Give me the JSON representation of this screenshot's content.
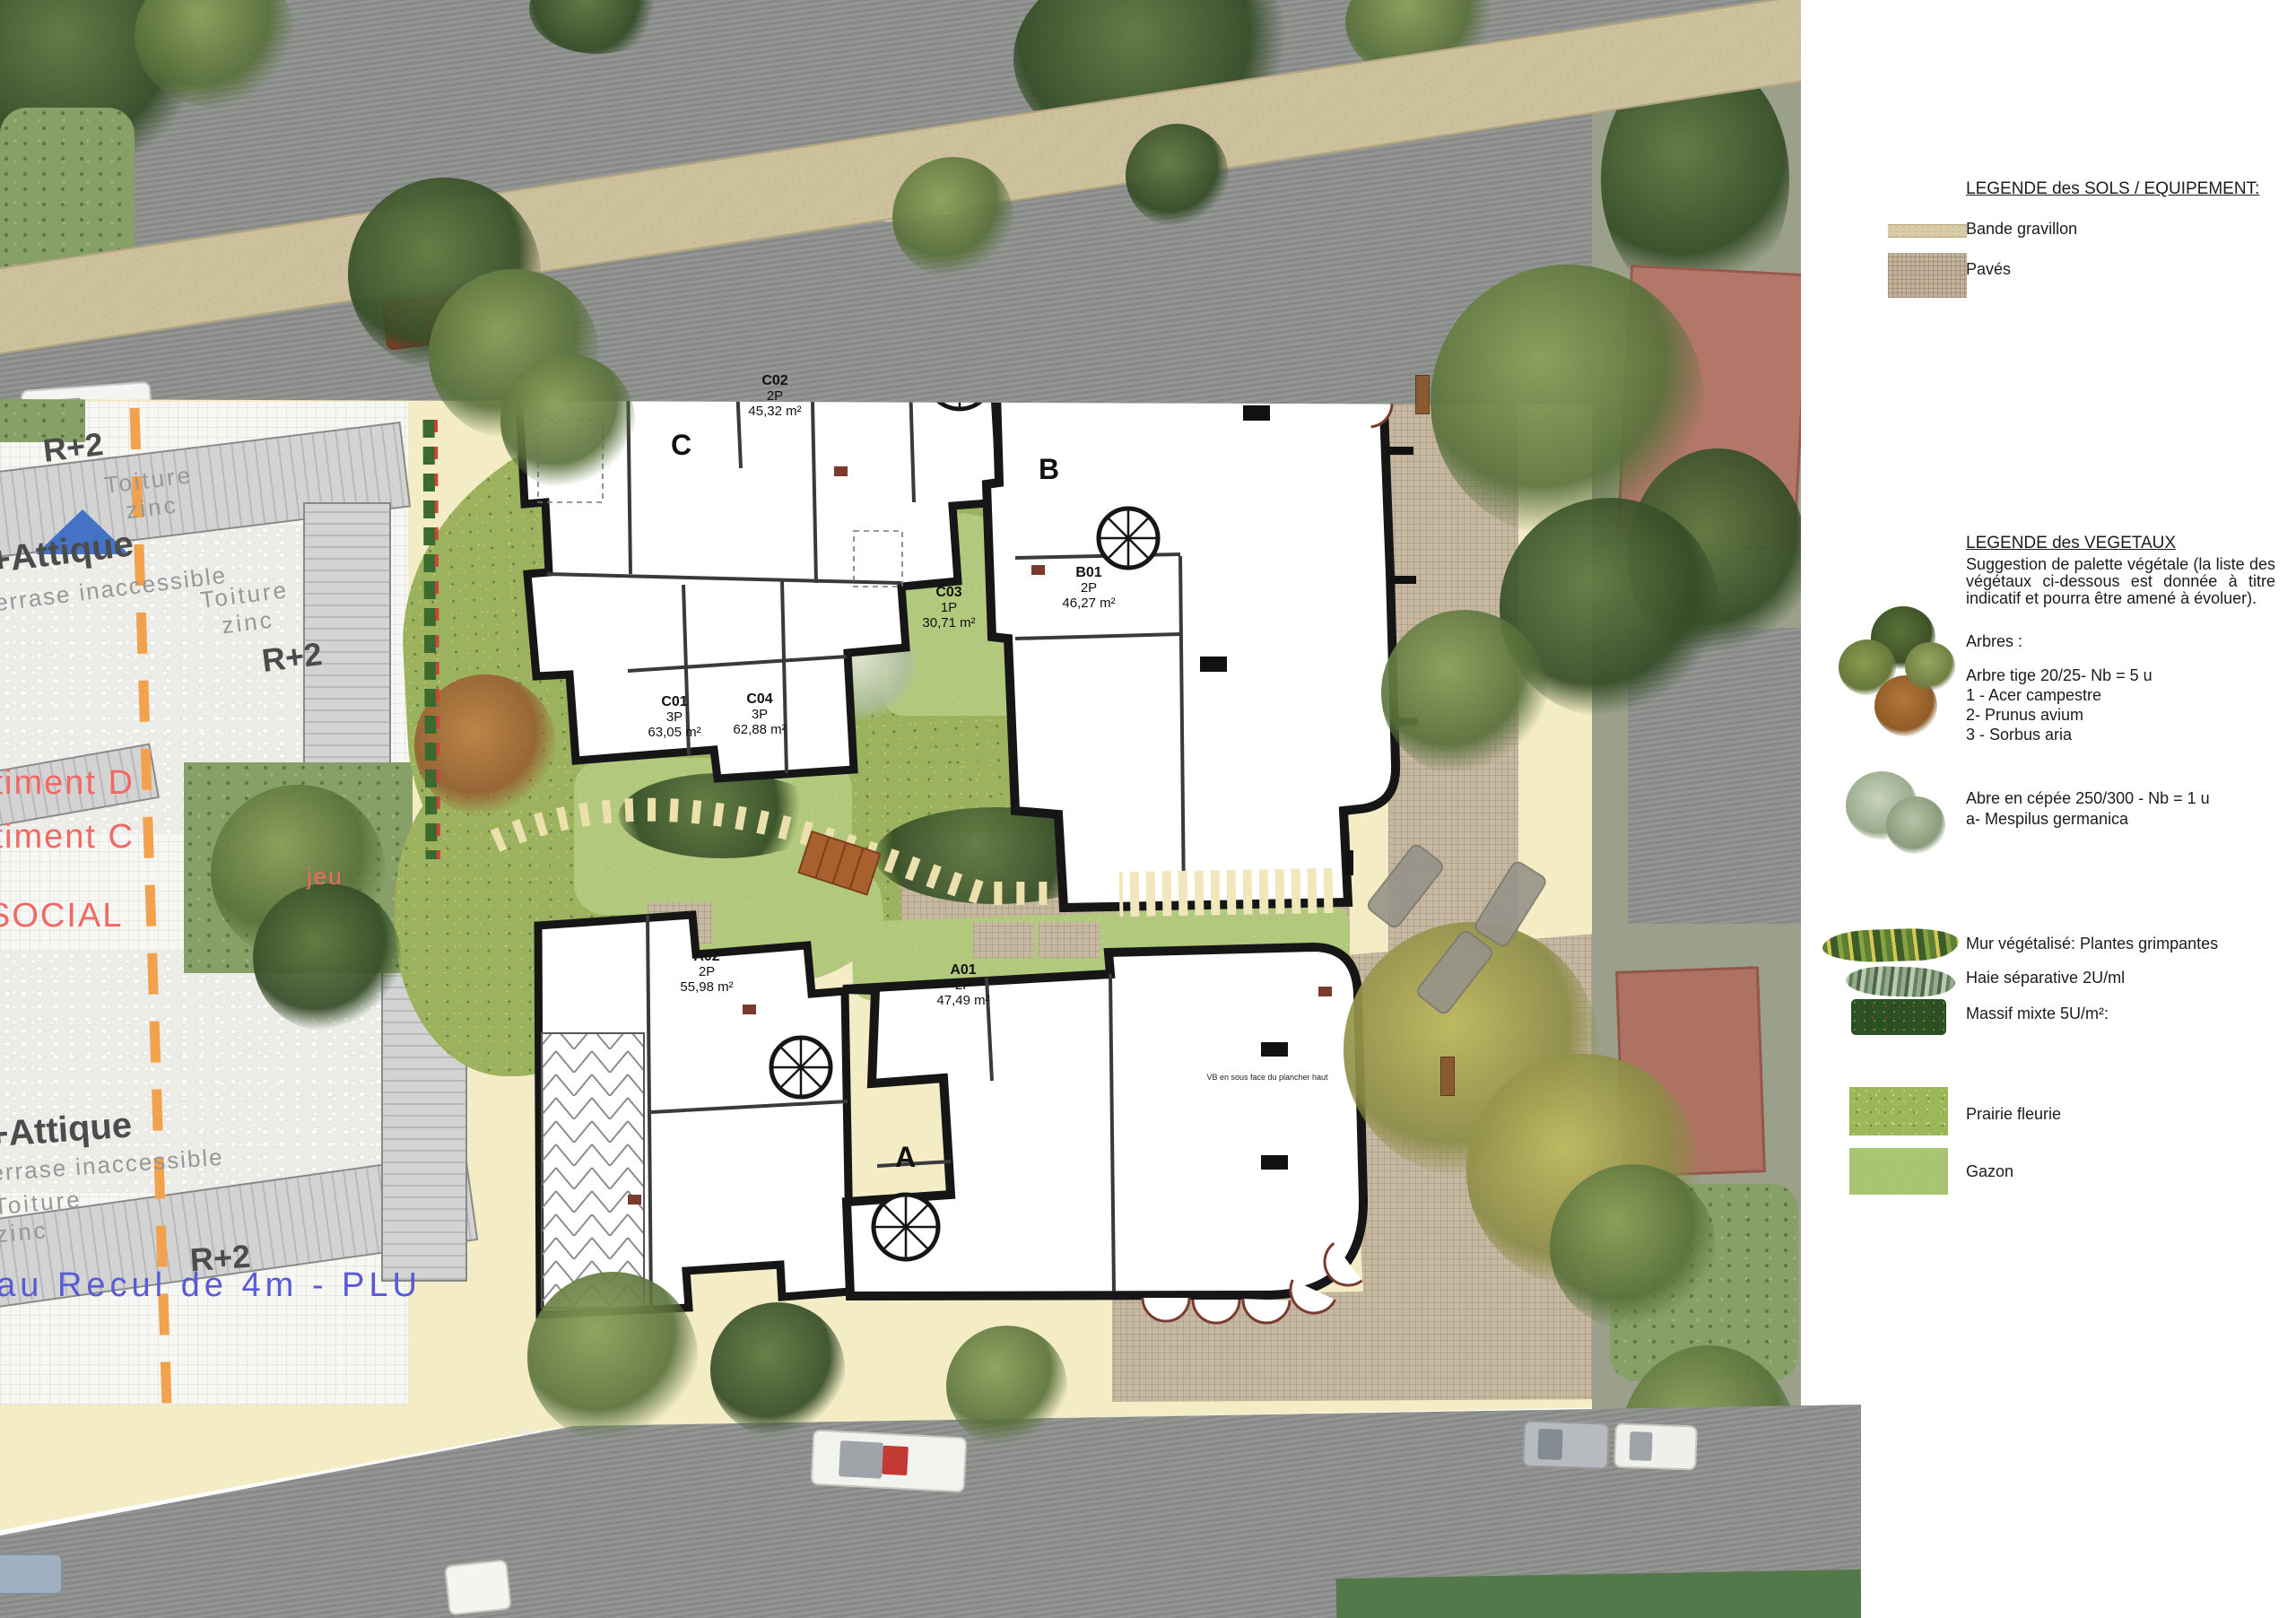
{
  "colors": {
    "site_cream": "#f3ecc5",
    "paves_tan": "#c7b8a2",
    "gazon_green": "#b2c87c",
    "prairie_green": "#9cb25f",
    "roof_zinc": "#c9c9c9",
    "boundary_orange": "#f2a24c",
    "label_red": "#f26964",
    "label_blue": "#585ad6",
    "triangle_blue": "#4472c4",
    "wall_black": "#161616"
  },
  "legend_sols": {
    "title": "LEGENDE des SOLS / EQUIPEMENT:",
    "gravillon": "Bande gravillon",
    "paves": "Pavés"
  },
  "legend_vegetaux": {
    "title": "LEGENDE des VEGETAUX",
    "intro": "Suggestion de palette végétale (la liste des végétaux ci-dessous est donnée à titre indicatif et pourra être amené à évoluer).",
    "arbres_heading": "Arbres :",
    "arbre_tige": "Arbre tige 20/25- Nb = 5 u",
    "tige_1": "1 - Acer campestre",
    "tige_2": "2- Prunus avium",
    "tige_3": "3 - Sorbus aria",
    "cepee": "Abre en cépée 250/300 - Nb = 1 u",
    "cepee_item": "a- Mespilus germanica",
    "mur": "Mur végétalisé: Plantes grimpantes",
    "haie": "Haie séparative 2U/ml",
    "massif": "Massif mixte  5U/m²:",
    "prairie": "Prairie fleurie",
    "gazon": "Gazon"
  },
  "plan": {
    "letters": {
      "a": "A",
      "b": "B",
      "c": "C"
    },
    "units": [
      {
        "id": "C02",
        "rooms": "2P",
        "area": "45,32 m²"
      },
      {
        "id": "C03",
        "rooms": "1P",
        "area": "30,71 m²"
      },
      {
        "id": "C01",
        "rooms": "3P",
        "area": "63,05 m²"
      },
      {
        "id": "C04",
        "rooms": "3P",
        "area": "62,88 m²"
      },
      {
        "id": "B01",
        "rooms": "2P",
        "area": "46,27 m²"
      },
      {
        "id": "A02",
        "rooms": "2P",
        "area": "55,98 m²"
      },
      {
        "id": "A01",
        "rooms": "2P",
        "area": "47,49 m²"
      }
    ],
    "note_a": "VB en sous face du plancher haut"
  },
  "neighbor": {
    "r2": "R+2",
    "toiture": "Toiture",
    "zinc": "zinc",
    "attique": "+Attique",
    "terrase": "terrase inaccessible",
    "batiment_d": "Bâtiment D",
    "batiment_c": "Bâtiment C",
    "social": "SOCIAL",
    "jeu": "jeu",
    "recul": "eau Recul de 4m - PLU"
  }
}
